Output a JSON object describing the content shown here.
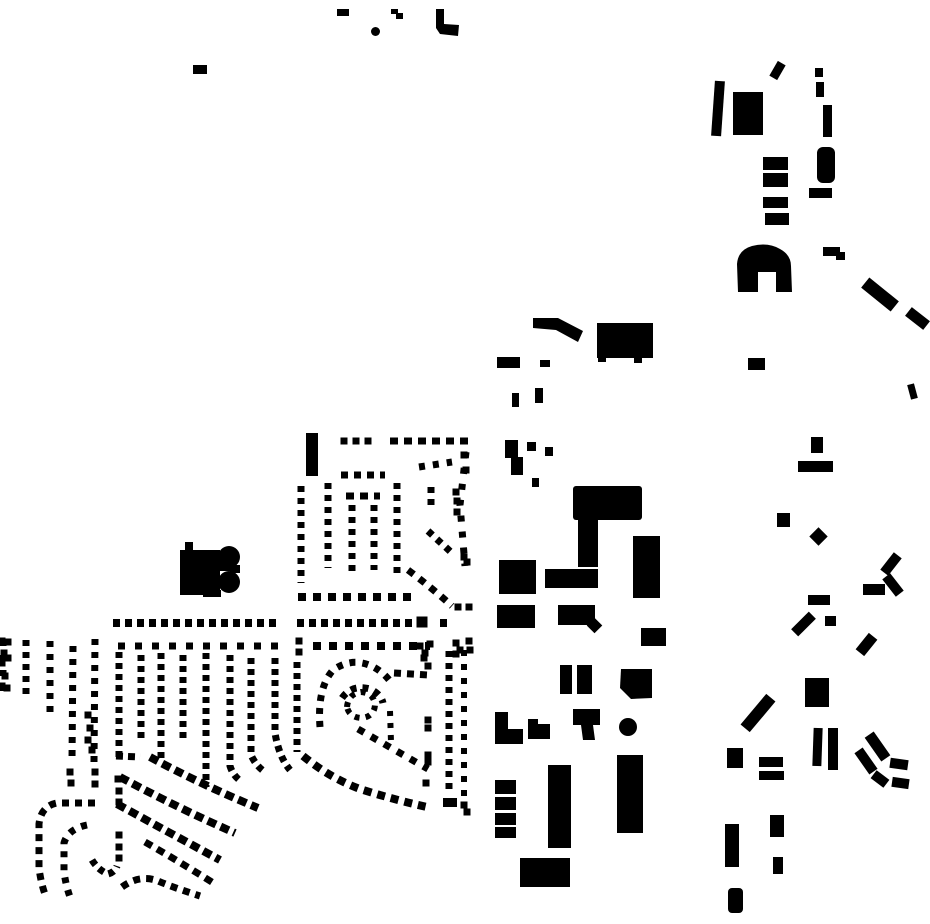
{
  "map": {
    "width": 930,
    "height": 924,
    "background_color": "#ffffff",
    "footprint_color": "#000000",
    "buildings": {
      "rects": [
        [
          337,
          9,
          12,
          7
        ],
        [
          193,
          65,
          14,
          9
        ],
        [
          306,
          433,
          12,
          43
        ],
        [
          773,
          62,
          9,
          17,
          30
        ],
        [
          815,
          68,
          8,
          9
        ],
        [
          816,
          82,
          8,
          15
        ],
        [
          733,
          92,
          30,
          43
        ],
        [
          713,
          81,
          10,
          55,
          4
        ],
        [
          823,
          105,
          9,
          32
        ],
        [
          817,
          147,
          18,
          36,
          0,
          6
        ],
        [
          763,
          157,
          25,
          13
        ],
        [
          763,
          173,
          25,
          14
        ],
        [
          763,
          197,
          25,
          11
        ],
        [
          765,
          213,
          24,
          12
        ],
        [
          809,
          188,
          23,
          10
        ],
        [
          823,
          247,
          17,
          9
        ],
        [
          836,
          252,
          9,
          8
        ],
        [
          861,
          288,
          38,
          13,
          39
        ],
        [
          906,
          313,
          23,
          11,
          38
        ],
        [
          777,
          513,
          13,
          14
        ],
        [
          812,
          530,
          13,
          13,
          45
        ],
        [
          880,
          559,
          22,
          10,
          -52
        ],
        [
          882,
          580,
          22,
          10,
          52
        ],
        [
          863,
          584,
          22,
          11
        ],
        [
          808,
          595,
          22,
          10
        ],
        [
          791,
          619,
          25,
          10,
          -45
        ],
        [
          825,
          616,
          11,
          10
        ],
        [
          856,
          639,
          21,
          11,
          -51
        ],
        [
          805,
          678,
          24,
          29
        ],
        [
          738,
          707,
          40,
          12,
          -50
        ],
        [
          813,
          728,
          9,
          38,
          2
        ],
        [
          828,
          728,
          10,
          42
        ],
        [
          863,
          741,
          29,
          11,
          55
        ],
        [
          853,
          756,
          26,
          10,
          55
        ],
        [
          872,
          774,
          16,
          10,
          37
        ],
        [
          890,
          759,
          18,
          10,
          8
        ],
        [
          892,
          778,
          17,
          10,
          8
        ],
        [
          727,
          748,
          16,
          20
        ],
        [
          759,
          757,
          24,
          10
        ],
        [
          759,
          771,
          25,
          9
        ],
        [
          725,
          824,
          14,
          43
        ],
        [
          770,
          815,
          14,
          22
        ],
        [
          773,
          857,
          10,
          17
        ],
        [
          728,
          888,
          15,
          25,
          0,
          4
        ],
        [
          597,
          323,
          56,
          35
        ],
        [
          598,
          356,
          8,
          6
        ],
        [
          634,
          357,
          8,
          6
        ],
        [
          497,
          357,
          23,
          11
        ],
        [
          540,
          360,
          10,
          7
        ],
        [
          512,
          393,
          7,
          14
        ],
        [
          535,
          388,
          8,
          15
        ],
        [
          748,
          358,
          17,
          12
        ],
        [
          909,
          384,
          7,
          15,
          -15
        ],
        [
          527,
          442,
          9,
          9
        ],
        [
          545,
          447,
          8,
          9
        ],
        [
          532,
          478,
          7,
          9
        ],
        [
          811,
          437,
          12,
          16
        ],
        [
          798,
          461,
          35,
          11
        ],
        [
          573,
          486,
          69,
          34,
          0,
          3
        ],
        [
          578,
          517,
          20,
          50
        ],
        [
          545,
          569,
          53,
          19
        ],
        [
          499,
          560,
          37,
          34
        ],
        [
          633,
          536,
          27,
          62
        ],
        [
          497,
          605,
          38,
          23
        ],
        [
          558,
          605,
          37,
          20
        ],
        [
          589,
          620,
          11,
          11,
          45
        ],
        [
          641,
          628,
          25,
          18
        ],
        [
          560,
          665,
          12,
          29
        ],
        [
          577,
          665,
          15,
          29
        ],
        [
          495,
          780,
          21,
          14
        ],
        [
          495,
          797,
          21,
          13
        ],
        [
          495,
          813,
          21,
          12
        ],
        [
          495,
          827,
          21,
          11
        ],
        [
          548,
          765,
          23,
          83
        ],
        [
          617,
          755,
          26,
          78
        ],
        [
          520,
          858,
          50,
          29
        ],
        [
          180,
          550,
          40,
          45
        ],
        [
          185,
          542,
          8,
          9
        ],
        [
          218,
          558,
          16,
          13
        ],
        [
          230,
          565,
          10,
          8
        ],
        [
          203,
          590,
          18,
          7
        ],
        [
          443,
          798,
          14,
          9
        ]
      ],
      "polygons": [
        "391,9 398,9 398,13 403,13 403,19 396,19 396,14 391,14",
        "436,9 444,9 444,24 459,25 458,36 440,34 436,28",
        "533,318 558,318 583,331 578,342 556,330 533,328",
        "505,440 518,440 518,457 523,457 523,475 511,475 511,458 505,458",
        "621,669 652,669 652,698 631,699 620,688",
        "495,712 508,712 508,729 523,729 523,744 495,744",
        "528,719 538,719 538,724 550,724 550,739 528,739",
        "573,709 600,709 600,725 593,725 595,740 583,740 581,725 573,725"
      ],
      "circles": [
        [
          375.5,
          31.5,
          4.5
        ],
        [
          229,
          557,
          11
        ],
        [
          229,
          582,
          11
        ],
        [
          628,
          727,
          9
        ]
      ],
      "paths": [
        "M738 292 L737 264 Q738 250 752 246 Q768 242 780 249 Q791 255 791 266 L792 292 L776 292 L776 272 L758 272 L758 292 Z"
      ]
    },
    "streets": [
      {
        "d": "M390 441 L470 441",
        "w": 7,
        "dash": "8 6"
      },
      {
        "d": "M341 475 L385 475",
        "w": 7,
        "dash": "7 6"
      },
      {
        "d": "M301 486 L301 583",
        "w": 7,
        "dash": "6 6"
      },
      {
        "d": "M328 483 L328 568",
        "w": 7,
        "dash": "6 6"
      },
      {
        "d": "M352 505 L352 577",
        "w": 7,
        "dash": "6 6"
      },
      {
        "d": "M374 505 L374 570",
        "w": 7,
        "dash": "6 6"
      },
      {
        "d": "M397 483 L397 577",
        "w": 7,
        "dash": "6 6"
      },
      {
        "d": "M346 496 L380 496",
        "w": 7,
        "dash": "8 6"
      },
      {
        "d": "M298 597 L415 597",
        "w": 8,
        "dash": "8 7"
      },
      {
        "d": "M113 623 L278 623",
        "w": 8,
        "dash": "7 5"
      },
      {
        "d": "M297 623 L415 623",
        "w": 8,
        "dash": "7 5"
      },
      {
        "d": "M440 623 L452 623",
        "w": 8,
        "dash": "7 5"
      },
      {
        "d": "M118 646 L282 646",
        "w": 7,
        "dash": "7 10"
      },
      {
        "d": "M313 646 L430 646",
        "w": 8,
        "dash": "8 8"
      },
      {
        "d": "M408 570 Q432 588 452 606",
        "w": 7,
        "dash": "7 7"
      },
      {
        "d": "M466 452 L460 505 L465 566",
        "w": 7,
        "dash": "6 10"
      },
      {
        "d": "M428 531 L452 553",
        "w": 7,
        "dash": "6 6"
      },
      {
        "d": "M431 487 L431 507",
        "w": 7,
        "dash": "6 6"
      },
      {
        "d": "M419 467 L452 462",
        "w": 7,
        "dash": "6 8"
      },
      {
        "d": "M3 640 L3 691",
        "w": 7,
        "dash": "6 9"
      },
      {
        "d": "M26 640 L26 698",
        "w": 7,
        "dash": "6 6"
      },
      {
        "d": "M50 641 L50 714",
        "w": 7,
        "dash": "6 7"
      },
      {
        "d": "M73 646 L72 760",
        "w": 7,
        "dash": "6 7"
      },
      {
        "d": "M95 639 L94 762",
        "w": 7,
        "dash": "6 7"
      },
      {
        "d": "M119 652 L119 760",
        "w": 7,
        "dash": "6 5"
      },
      {
        "d": "M141 655 L141 740",
        "w": 7,
        "dash": "6 5"
      },
      {
        "d": "M161 653 L161 763",
        "w": 7,
        "dash": "6 5"
      },
      {
        "d": "M183 655 L183 743",
        "w": 7,
        "dash": "6 5"
      },
      {
        "d": "M206 653 L206 787",
        "w": 7,
        "dash": "6 5"
      },
      {
        "d": "M230 655 L230 766 Q233 776 242 782",
        "w": 7,
        "dash": "6 5"
      },
      {
        "d": "M251 658 L251 755 Q256 766 265 772",
        "w": 7,
        "dash": "6 5"
      },
      {
        "d": "M275 658 L275 733 Q279 757 290 770",
        "w": 7,
        "dash": "6 5"
      },
      {
        "d": "M297 662 L297 752",
        "w": 7,
        "dash": "6 5"
      },
      {
        "d": "M116 756 L140 757",
        "w": 7,
        "dash": "7 5"
      },
      {
        "d": "M150 757 Q200 784 258 808",
        "w": 8,
        "dash": "9 5"
      },
      {
        "d": "M120 777 Q180 809 235 833",
        "w": 8,
        "dash": "9 5"
      },
      {
        "d": "M117 804 Q170 833 220 860",
        "w": 8,
        "dash": "9 5"
      },
      {
        "d": "M145 842 Q180 862 215 884",
        "w": 7,
        "dash": "8 6"
      },
      {
        "d": "M122 887 Q140 874 158 881 Q172 887 200 896",
        "w": 7,
        "dash": "7 6"
      },
      {
        "d": "M95 803 L57 803 Q41 806 39 824 L39 868 Q41 884 46 897",
        "w": 7,
        "dash": "7 6"
      },
      {
        "d": "M87 825 Q68 829 64 843 L64 872 Q66 886 70 897",
        "w": 7,
        "dash": "6 7"
      },
      {
        "d": "M92 860 Q98 870 108 874 Q115 872 117 866",
        "w": 7,
        "dash": "6 5"
      },
      {
        "d": "M320 727 Q317 688 333 670 Q348 660 362 663 Q378 666 390 681",
        "w": 7,
        "dash": "6 7"
      },
      {
        "d": "M394 673 L428 675",
        "w": 7,
        "dash": "7 6"
      },
      {
        "d": "M342 698 Q352 684 370 689 Q381 694 383 703",
        "w": 7,
        "dash": "6 6"
      },
      {
        "d": "M347 707 Q348 694 361 692 Q374 693 375 705 Q374 717 361 718 Q349 717 347 707",
        "w": 6,
        "dash": "5 6"
      },
      {
        "d": "M358 729 L428 769",
        "w": 7,
        "dash": "7 8"
      },
      {
        "d": "M390 711 L391 742",
        "w": 6,
        "dash": "5 7"
      },
      {
        "d": "M303 756 Q330 778 360 789 Q395 800 427 807",
        "w": 8,
        "dash": "8 6"
      },
      {
        "d": "M449 651 L449 795",
        "w": 7,
        "dash": "6 6"
      },
      {
        "d": "M464 650 L464 800",
        "w": 6,
        "dash": "6 8"
      }
    ],
    "dots": [
      [
        344,
        441
      ],
      [
        356,
        441
      ],
      [
        368,
        441
      ],
      [
        464,
        455
      ],
      [
        466,
        470
      ],
      [
        456,
        492
      ],
      [
        457,
        501
      ],
      [
        457,
        512
      ],
      [
        464,
        557
      ],
      [
        467,
        562
      ],
      [
        458,
        607
      ],
      [
        469,
        607
      ],
      [
        422,
        622,
        11
      ],
      [
        299,
        641
      ],
      [
        299,
        652
      ],
      [
        420,
        646
      ],
      [
        425,
        653
      ],
      [
        456,
        643
      ],
      [
        460,
        650
      ],
      [
        469,
        641
      ],
      [
        470,
        650
      ],
      [
        2,
        641
      ],
      [
        8,
        642
      ],
      [
        4,
        653
      ],
      [
        8,
        658
      ],
      [
        2,
        663
      ],
      [
        5,
        676
      ],
      [
        2,
        686
      ],
      [
        7,
        688
      ],
      [
        70,
        772
      ],
      [
        71,
        783
      ],
      [
        95,
        772
      ],
      [
        95,
        784
      ],
      [
        118,
        779
      ],
      [
        119,
        791
      ],
      [
        119,
        802
      ],
      [
        119,
        835
      ],
      [
        119,
        847
      ],
      [
        119,
        858
      ],
      [
        88,
        715
      ],
      [
        90,
        728
      ],
      [
        88,
        740
      ],
      [
        92,
        750
      ],
      [
        456,
        654
      ],
      [
        426,
        783
      ],
      [
        424,
        658
      ],
      [
        428,
        666
      ],
      [
        430,
        644
      ],
      [
        428,
        720
      ],
      [
        428,
        728
      ],
      [
        428,
        755
      ],
      [
        428,
        762
      ],
      [
        464,
        805
      ],
      [
        467,
        812
      ]
    ]
  }
}
